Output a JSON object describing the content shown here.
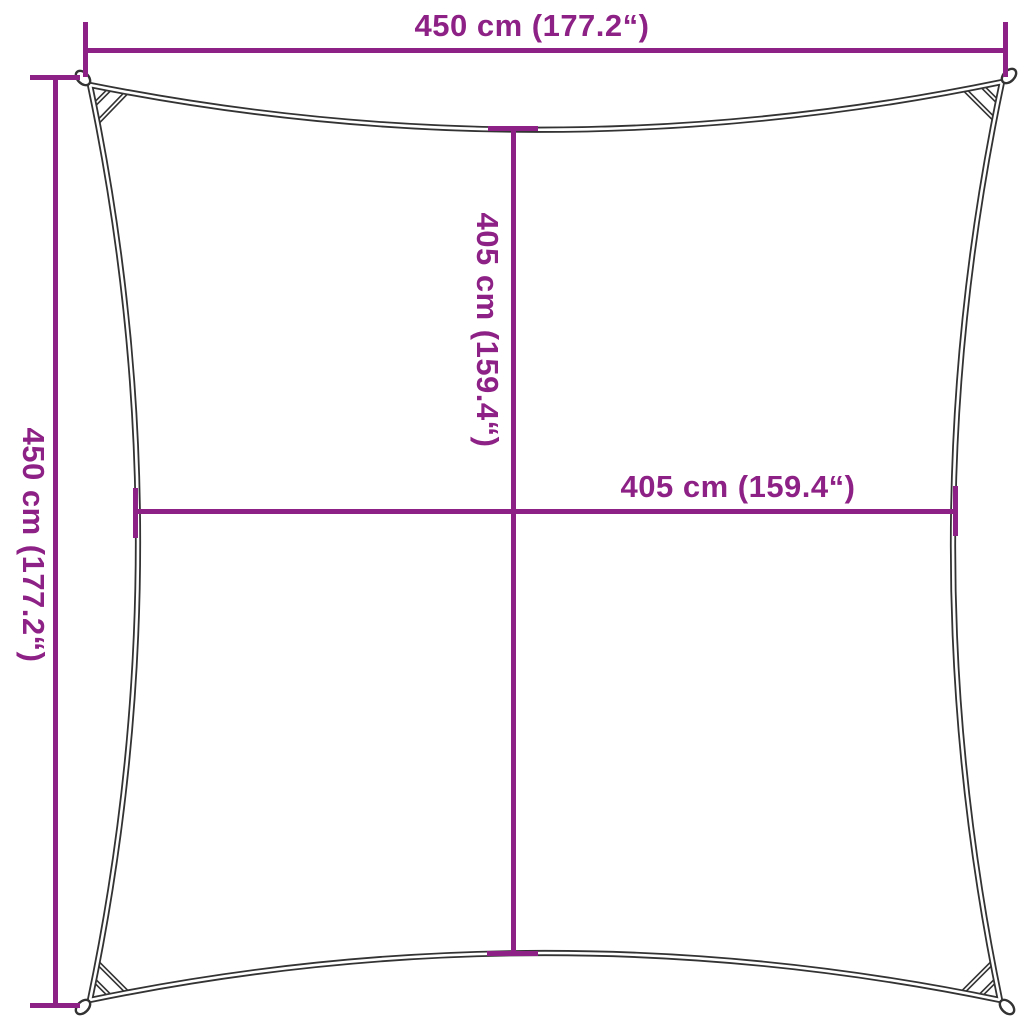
{
  "dimensions": {
    "top": {
      "label": "450 cm (177.2“)"
    },
    "left": {
      "label": "450 cm (177.2“)"
    },
    "center_vertical": {
      "label": "405 cm (159.4“)"
    },
    "center_horizontal": {
      "label": "405 cm (159.4“)"
    }
  },
  "colors": {
    "dimension_accent": "#8E2185",
    "sail_outline": "#333333",
    "background": "#FFFFFF"
  }
}
